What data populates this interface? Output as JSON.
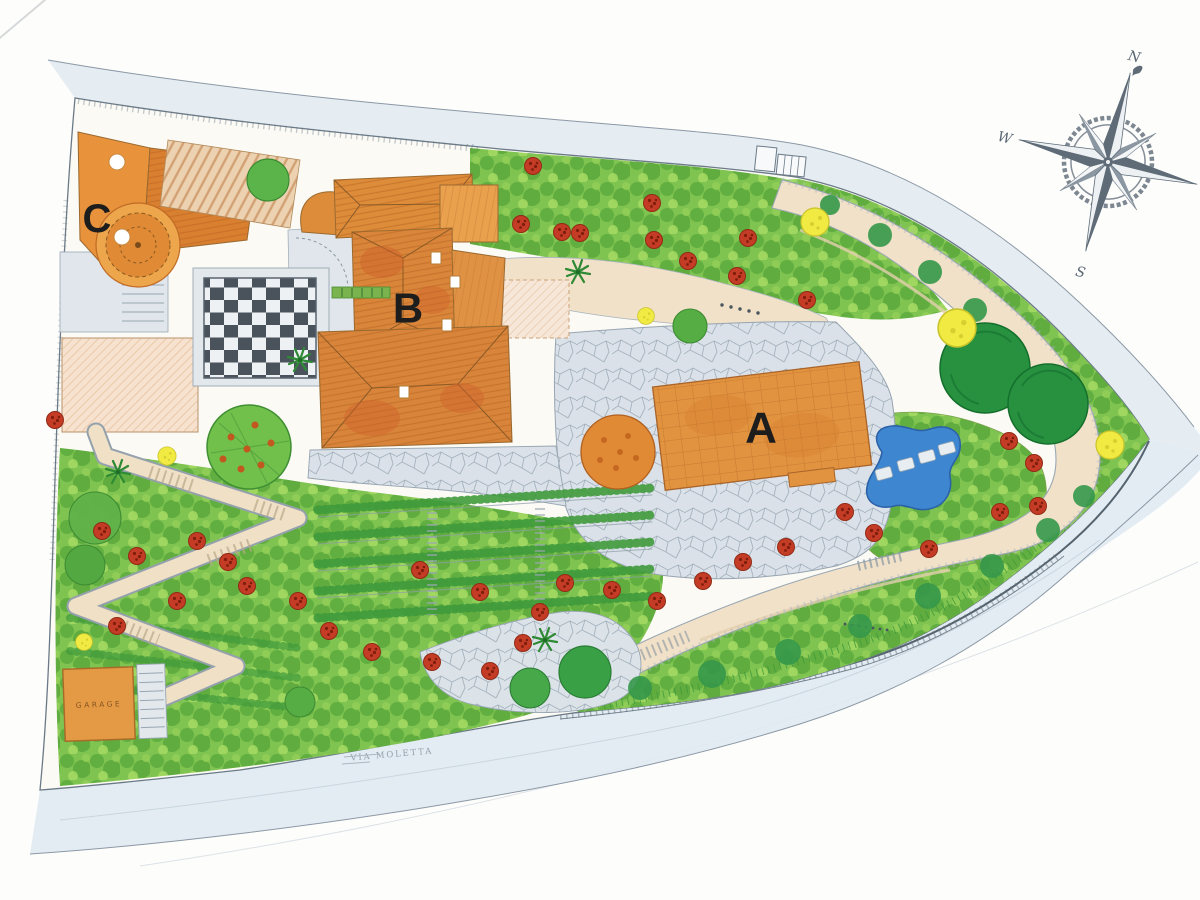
{
  "labels": {
    "building_a": "A",
    "building_b": "B",
    "building_c": "C",
    "garage": "GARAGE"
  },
  "roads": {
    "top_word1": "Mallela",
    "top_word2": "Sassella",
    "bottom": "VIA MOLETTA"
  },
  "compass": {
    "north": "N",
    "east": "E",
    "south": "S",
    "west": "W"
  },
  "palette": {
    "paper": "#fbfaf5",
    "road_wash": "#e2ebf2",
    "outline_gray": "#6b7a86",
    "roof_orange": "#df8c3a",
    "roof_deep_orange": "#c96b2a",
    "driveway_beige": "#f1e1c8",
    "plaza_gray": "#dae1e8",
    "grass_green": "#7fc350",
    "grass_dark": "#4c9c33",
    "big_tree_green": "#27913f",
    "tree_yellow": "#f0ea43",
    "flower_red": "#c43c25",
    "pool_blue": "#3e86d0",
    "checker_dark": "#4a525c",
    "letter_black": "#1d1d1d"
  }
}
